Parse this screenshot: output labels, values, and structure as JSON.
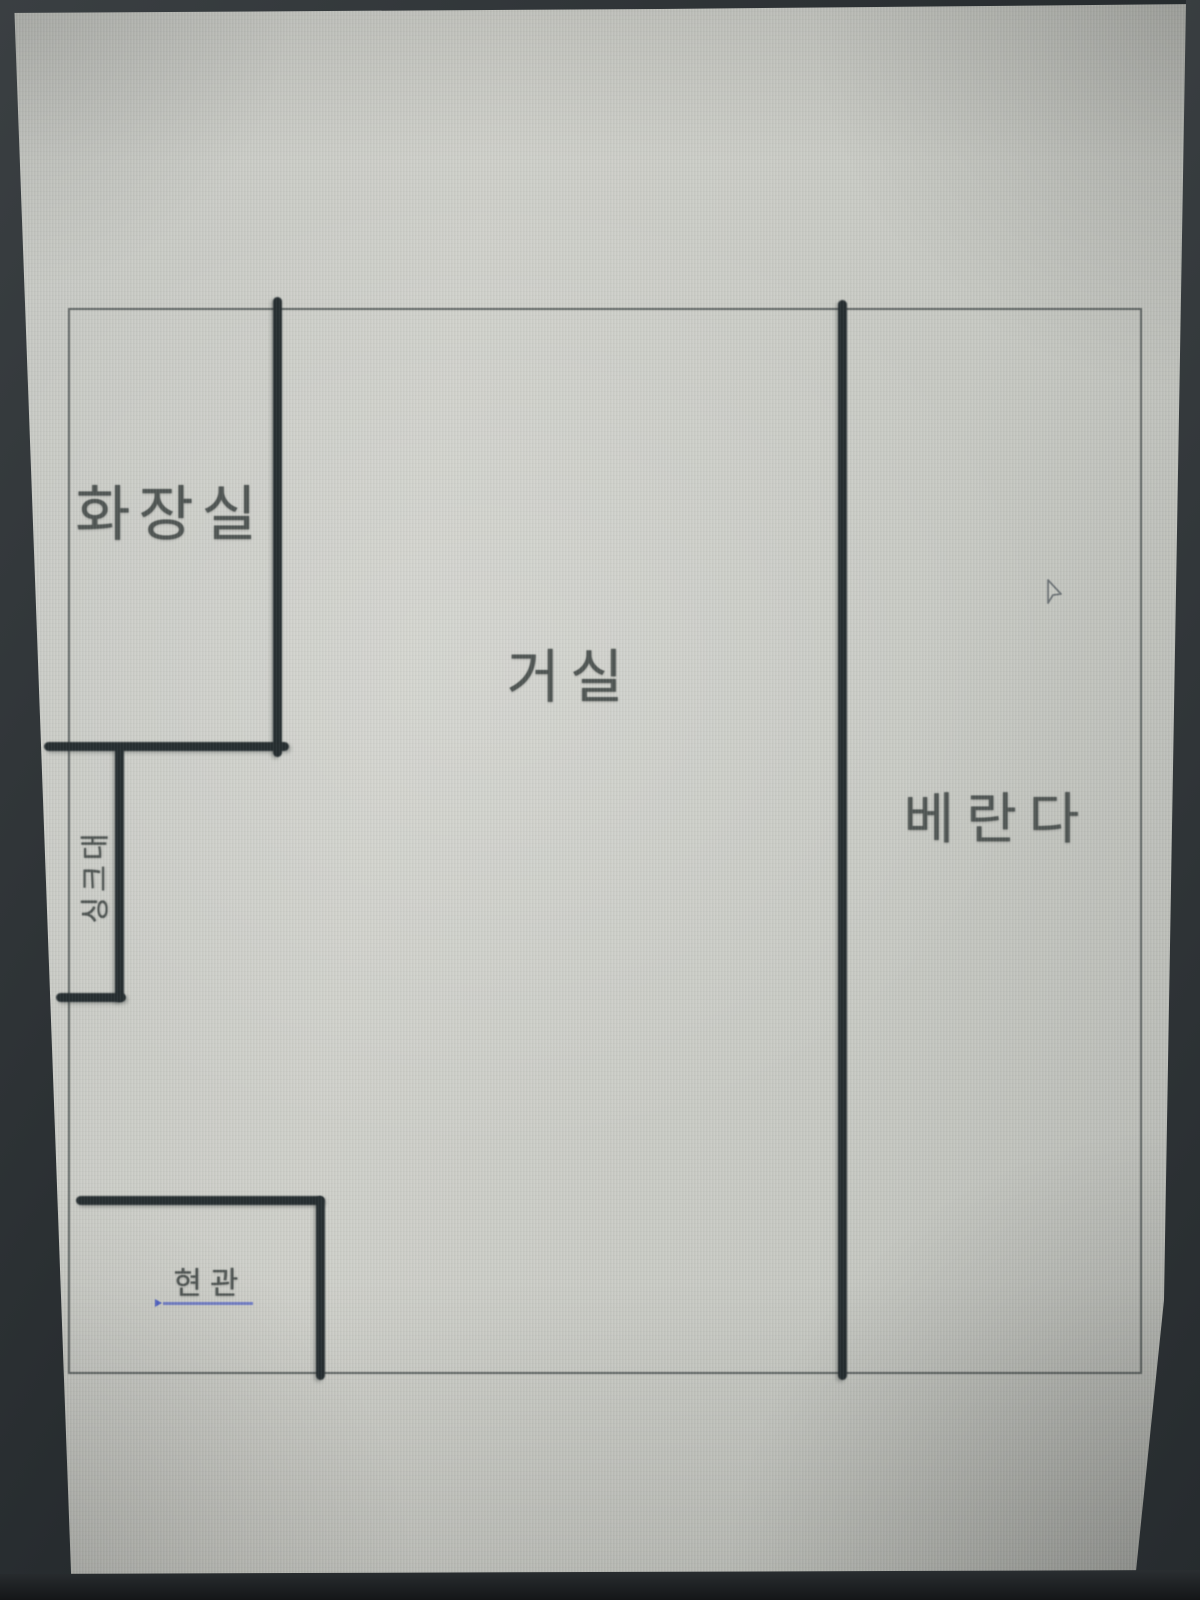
{
  "window": {
    "type": "photographed-monitor-screen",
    "content": "apartment-floor-plan-sketch"
  },
  "floor_plan": {
    "rooms": [
      {
        "id": "bathroom",
        "label": "화장실",
        "position": "top-left"
      },
      {
        "id": "sink",
        "label": "싱크대",
        "position": "left-middle",
        "orientation": "vertical"
      },
      {
        "id": "entrance",
        "label": "현관",
        "position": "bottom-left",
        "underlined": true
      },
      {
        "id": "living-room",
        "label": "거실",
        "position": "center"
      },
      {
        "id": "veranda",
        "label": "베란다",
        "position": "right"
      }
    ],
    "colors": {
      "thick_wall": "#232b2e",
      "thin_outline": "#484e4e",
      "label_text": "#4e5452",
      "entrance_underline": "#5565c8",
      "screen_background": "#c9cbc5",
      "bezel": "#2b3034"
    }
  },
  "cursor": {
    "name": "mouse-pointer"
  }
}
